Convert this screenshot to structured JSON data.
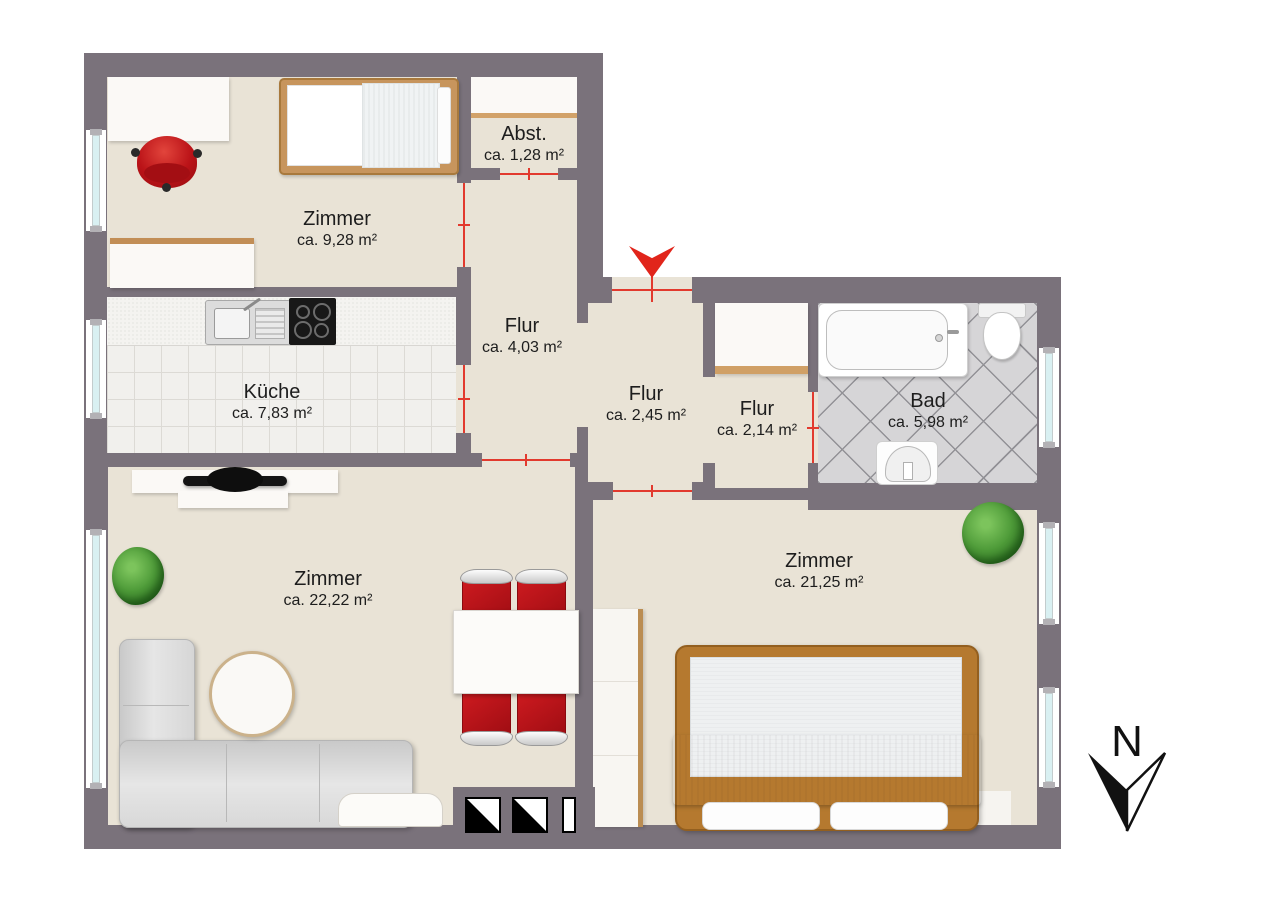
{
  "rooms": [
    {
      "name": "Zimmer",
      "area": "ca. 9,28 m²"
    },
    {
      "name": "Abst.",
      "area": "ca. 1,28 m²"
    },
    {
      "name": "Flur",
      "area": "ca. 4,03 m²"
    },
    {
      "name": "Küche",
      "area": "ca. 7,83 m²"
    },
    {
      "name": "Flur",
      "area": "ca. 2,45 m²"
    },
    {
      "name": "Flur",
      "area": "ca. 2,14 m²"
    },
    {
      "name": "Bad",
      "area": "ca. 5,98 m²"
    },
    {
      "name": "Zimmer",
      "area": "ca. 22,22 m²"
    },
    {
      "name": "Zimmer",
      "area": "ca. 21,25 m²"
    }
  ],
  "compass": {
    "north_label": "N"
  },
  "colors": {
    "wall": "#7a727b",
    "floor": "#e9e3d6",
    "door_line": "#e23a2e",
    "entrance_arrow": "#e1251b",
    "kitchen_tile": "#f1f0ed",
    "bath_tile": "#d6d5d7",
    "window_glass": "#d9f0f2",
    "wood_light": "#c7955d",
    "wood_dark": "#b5792f",
    "chair_red": "#bb1318",
    "sofa_gray": "#d9d9d9",
    "plant_green": "#4d9a38"
  }
}
